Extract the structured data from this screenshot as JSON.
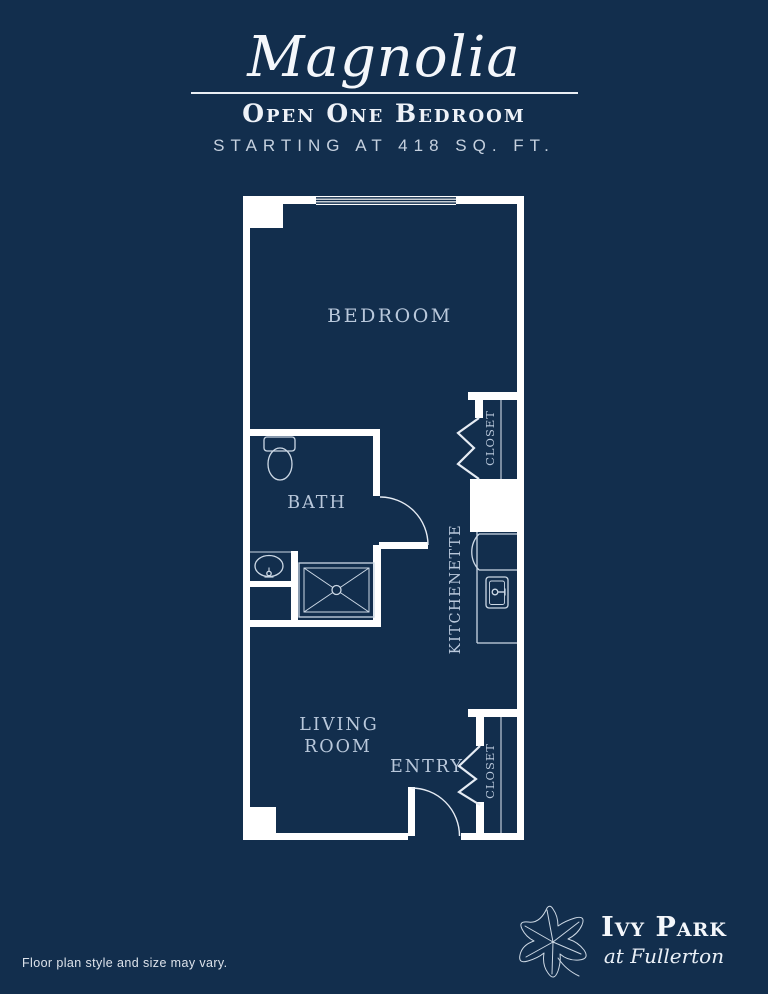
{
  "header": {
    "plan_name": "Magnolia",
    "plan_type": "Open One Bedroom",
    "size_note": "STARTING AT 418 SQ. FT."
  },
  "floor_plan": {
    "rooms": {
      "bedroom": "BEDROOM",
      "bath": "BATH",
      "living_line1": "LIVING",
      "living_line2": "ROOM",
      "entry": "ENTRY",
      "kitchenette": "KITCHENETTE",
      "closet_upper": "CLOSET",
      "closet_lower": "CLOSET"
    },
    "fixtures": [
      "toilet",
      "vanity-sink",
      "shower",
      "refrigerator",
      "kitchenette-sink",
      "bifold-closet-doors",
      "swing-doors",
      "window"
    ]
  },
  "footer": {
    "disclaimer": "Floor plan style and size may vary.",
    "logo": {
      "name": "Ivy Park",
      "location": "at Fullerton"
    }
  },
  "icons": {
    "logo_leaf": "ivy-leaf"
  },
  "colors": {
    "background": "#122e4d",
    "wall": "#ffffff",
    "fixture_line": "#ccd8e5",
    "label": "#b9c8db",
    "divider": "#e9eef4"
  }
}
